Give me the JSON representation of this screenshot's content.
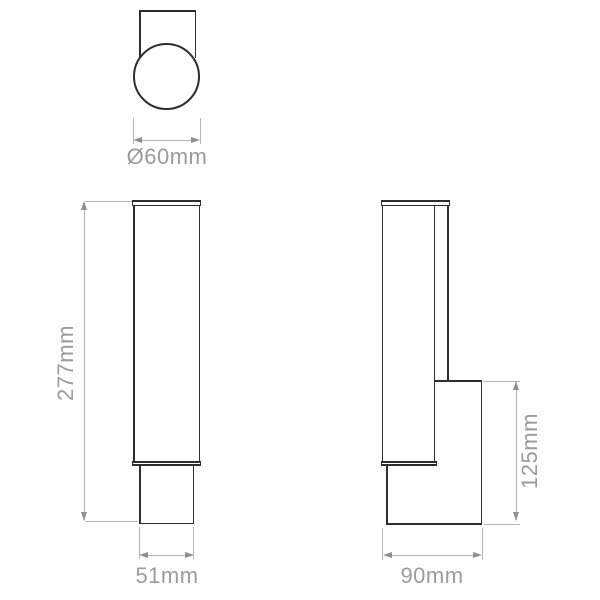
{
  "drawing": {
    "title": "Wall light technical dimension drawing",
    "colors": {
      "outline": "#2e2e2e",
      "dimension_line": "#b6b6b6",
      "arrow": "#8f8f8f",
      "label_text": "#9b9b9b",
      "background": "#ffffff"
    },
    "views": {
      "top_view": {
        "name": "top view",
        "diameter_label": "Ø60mm"
      },
      "front_view": {
        "name": "front view",
        "height_label": "277mm",
        "width_label": "51mm"
      },
      "side_view": {
        "name": "side view",
        "bracket_height_label": "125mm",
        "depth_label": "90mm"
      }
    }
  }
}
